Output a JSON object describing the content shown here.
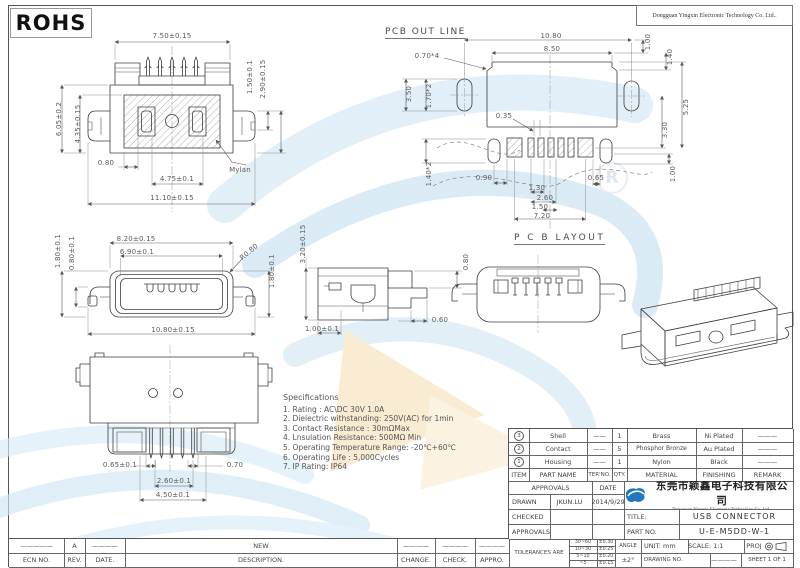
{
  "header": {
    "rohs": "ROHS",
    "company_en_top": "Dongguan Yingxin Electronic Technology Co. Ltd..",
    "watermark_r": "R"
  },
  "colors": {
    "logo_blue": "#1f77bf",
    "watermark_blue": "#d3e7f4",
    "watermark_sand": "#f6e2bd"
  },
  "views": {
    "top": {
      "d_pin_span": "7.50±0.15",
      "d_height": "6.05±0.2",
      "d_inner_height": "4.35±0.15",
      "d_right_small": "1.50±0.1",
      "d_right_big": "2.90±0.15",
      "d_edge": "0.80",
      "d_slot": "4.75±0.1",
      "d_total_width": "11.10±0.15",
      "note_mylar": "Mylan"
    },
    "pcb_outline": {
      "title": "PCB OUT LINE",
      "d1080": "10.80",
      "d850": "8.50",
      "d100_top": "1.00",
      "d140": "1.40",
      "d070x4": "0.70*4",
      "d350": "3.50",
      "d170x2": "1.70*2",
      "d035": "0.35",
      "d330": "3.30",
      "d525": "5.25",
      "d140x2": "1.40*2",
      "d090": "0.90",
      "d065": "0.65",
      "d130": "1.30",
      "d260": "2.60",
      "d150": "1.50",
      "d720": "7.20",
      "d100_bot": "1.00",
      "layout_title": "P C B LAYOUT"
    },
    "front": {
      "d820": "8.20±0.15",
      "d690": "6.90±0.1",
      "d180_left": "1.80±0.1",
      "d080_left": "0.80±0.1",
      "r080": "R0.80",
      "d180_right": "1.80±0.1",
      "d1080": "10.80±0.15"
    },
    "side": {
      "d320": "3.20±0.15",
      "d080": "0.80",
      "d060": "0.60",
      "d100": "1.00±0.1"
    },
    "rear": {
      "d065": "0.65±0.1",
      "d070": "0.70",
      "d260": "2.60±0.1",
      "d450": "4.50±0.1"
    }
  },
  "specifications": {
    "title": "Specifications",
    "items": [
      "1.  Rating :  AC\\DC 30V 1.0A",
      "2.  Dielectric withstanding: 250V(AC) for 1min",
      "3.  Contact Resistance :  30mΩMax",
      "4.  Lnsulation Resistance:  500MΩ Min",
      "5.  Operating Temperature Range:  -20℃+60℃",
      "6.  Operating Life :  5,000Cycles",
      "7.  IP Rating:  IP64"
    ]
  },
  "bom": {
    "headers": {
      "item": "ITEM",
      "part": "PART NAME",
      "ter": "TER'NO.",
      "qty": "QTY.",
      "material": "MATERIAL",
      "finishing": "FINISHING",
      "remark": "REMARK"
    },
    "rows": [
      {
        "num": "3",
        "part": "Shell",
        "ter": "——",
        "qty": "1",
        "material": "Brass",
        "finishing": "Ni Plated",
        "remark": "———"
      },
      {
        "num": "2",
        "part": "Contact",
        "ter": "——",
        "qty": "5",
        "material": "Phosphor Bronze",
        "finishing": "Au Plated",
        "remark": "———"
      },
      {
        "num": "1",
        "part": "Housing",
        "ter": "——",
        "qty": "1",
        "material": "Nylon",
        "finishing": "Black",
        "remark": "———"
      }
    ]
  },
  "title_block": {
    "approvals_header": "APPROVALS",
    "date_header": "DATE",
    "drawn_label": "DRAWN",
    "drawn_name": "JKUN.LU",
    "drawn_date": "2014/9/29",
    "checked_label": "CHECKED",
    "approvals_label": "APPROVALS",
    "company_cn": "东莞市颖鑫电子科技有限公司",
    "company_en": "Dongguan Yingxin Electronic Technology Co. Ltd..",
    "title_label": "TITLE:",
    "title_value": "USB  CONNECTOR",
    "part_no_label": "PART NO.",
    "part_no_value": "U-E-M5DD-W-1",
    "tolerances_label": "TOLERANCES ARE",
    "tolerances": [
      {
        "range": "30~60",
        "tol": "±0.30"
      },
      {
        "range": "10~30",
        "tol": "±0.25"
      },
      {
        "range": "5~10",
        "tol": "±0.20"
      },
      {
        "range": "~5",
        "tol": "±0.15"
      }
    ],
    "angle_label": "ANGLE",
    "angle_value": "±2°",
    "unit_label": "UNIT:  mm",
    "scale_label": "SCALE:  1:1",
    "proj_label": "PROJ",
    "drawing_no_label": "DRAWING NO.",
    "drawing_no_value": "————",
    "sheet_label": "SHEET  1 OF 1"
  },
  "revision": {
    "row_values": {
      "ecn": "—————",
      "rev": "A",
      "date": "————",
      "description": "NEW",
      "change": "————",
      "check": "————",
      "appro": "————"
    },
    "row_labels": {
      "ecn": "ECN  NO.",
      "rev": "REV.",
      "date": "DATE.",
      "description": "DESCRIPTION.",
      "change": "CHANGE.",
      "check": "CHECK.",
      "appro": "APPRO."
    }
  }
}
